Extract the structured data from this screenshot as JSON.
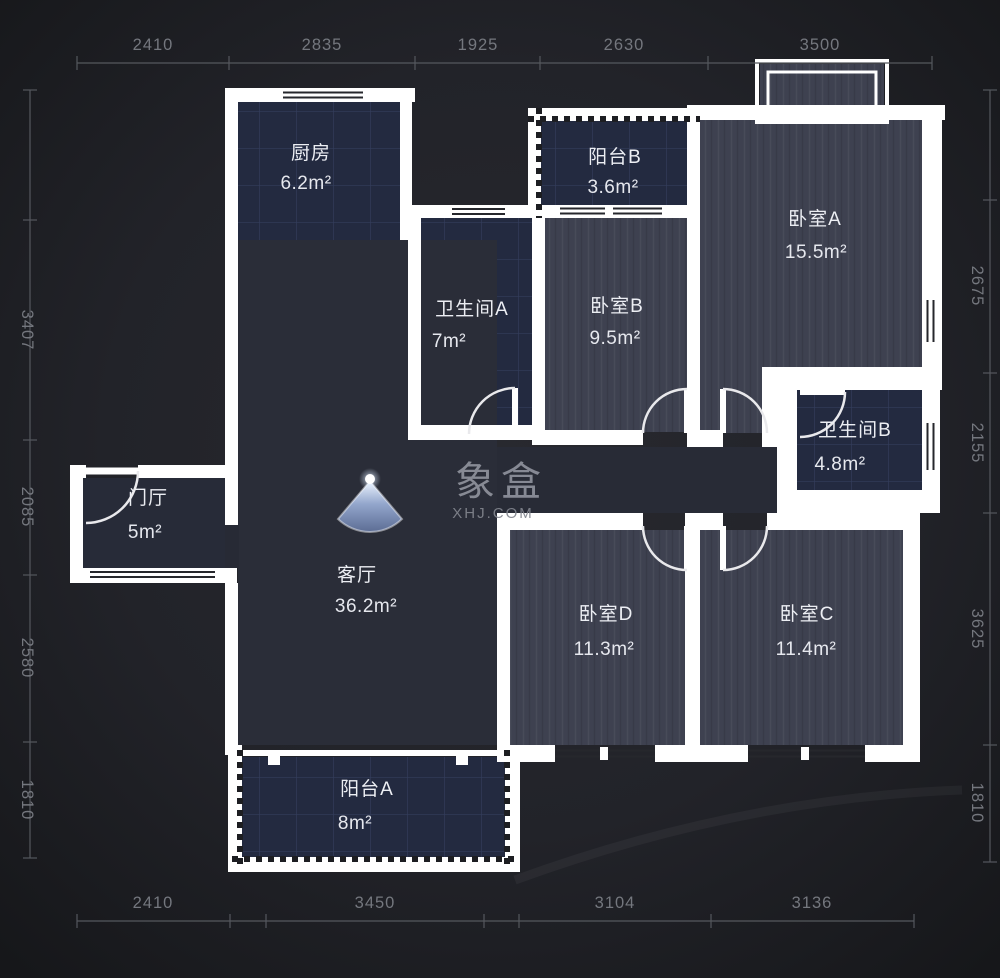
{
  "watermark": {
    "logo": "象盒",
    "site": "XHJ.COM"
  },
  "rooms": {
    "kitchen": {
      "name": "厨房",
      "area": "6.2m²"
    },
    "balcony_b": {
      "name": "阳台B",
      "area": "3.6m²"
    },
    "bedroom_a": {
      "name": "卧室A",
      "area": "15.5m²"
    },
    "bathroom_a": {
      "name": "卫生间A",
      "area": "7m²"
    },
    "bedroom_b": {
      "name": "卧室B",
      "area": "9.5m²"
    },
    "bathroom_b": {
      "name": "卫生间B",
      "area": "4.8m²"
    },
    "entry": {
      "name": "门厅",
      "area": "5m²"
    },
    "living": {
      "name": "客厅",
      "area": "36.2m²"
    },
    "bedroom_d": {
      "name": "卧室D",
      "area": "11.3m²"
    },
    "bedroom_c": {
      "name": "卧室C",
      "area": "11.4m²"
    },
    "balcony_a": {
      "name": "阳台A",
      "area": "8m²"
    }
  },
  "dimensions": {
    "top": [
      "2410",
      "2835",
      "1925",
      "2630",
      "3500"
    ],
    "bottom": [
      "2410",
      "3450",
      "3104",
      "3136"
    ],
    "left": [
      "3407",
      "2085",
      "2580",
      "1810"
    ],
    "right": [
      "2675",
      "2155",
      "3625",
      "1810"
    ]
  },
  "colors": {
    "background": "#222329",
    "wall": "#ffffff",
    "wood_floor": "#3e4150",
    "tile_floor": "#232a40",
    "living_floor": "#2a2d38",
    "dimension_text": "#74777e",
    "label_text": "#eceef3",
    "compass_top": "#eef5ff",
    "compass_bottom": "#5c6d94"
  }
}
